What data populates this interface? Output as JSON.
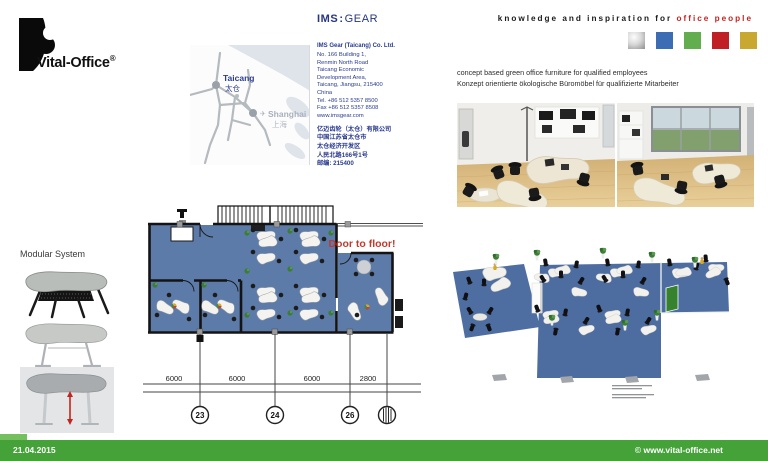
{
  "brand": {
    "name": "Vital-Office",
    "reg": "®"
  },
  "ims": {
    "bold": "IMS",
    "sep": ":",
    "rest": "GEAR"
  },
  "tagline": {
    "prefix": "knowledge and inspiration for",
    "highlight": "office people"
  },
  "palette": {
    "silver": "silver-gradient",
    "blue": "#3B6CB4",
    "green": "#62AE4E",
    "red": "#C01F26",
    "gold": "#C9A832"
  },
  "map": {
    "city": "Taicang",
    "city_cn": "太仓",
    "plane": "✈",
    "dest": "Shanghai",
    "dest_cn": "上海"
  },
  "address": {
    "company": "IMS Gear (Taicang) Co. Ltd.",
    "lines": [
      "No. 166 Building 1,",
      "Renmin North Road",
      "Taicang Economic",
      "Development Area,",
      "Taicang, Jiangsu, 215400",
      "China",
      "Tel. +86 512 5357 8500",
      "Fax +86 512 5357 8508",
      "www.imsgear.com"
    ],
    "cn_lines": [
      "亿迈齿轮（太仓）有限公司",
      "中国江苏省太仓市",
      "太仓经济开发区",
      "人民北路166号1号",
      "邮编: 215400"
    ]
  },
  "concept": {
    "line_en": "concept based green office furniture for qualified employees",
    "line_de": "Konzept orientierte ökologische Büromöbel für qualifizierte Mitarbeiter"
  },
  "modular": {
    "title": "Modular System"
  },
  "floorplan": {
    "door_note": "Door to floor!",
    "door_note_color": "#C03A2E",
    "carpet_color": "#5C7BA8",
    "dims": [
      "6000",
      "6000",
      "6000",
      "2800"
    ],
    "markers": [
      "23",
      "24",
      "26"
    ]
  },
  "footer": {
    "date": "21.04.2015",
    "site": "© www.vital-office.net",
    "bar_color": "#44A238"
  }
}
